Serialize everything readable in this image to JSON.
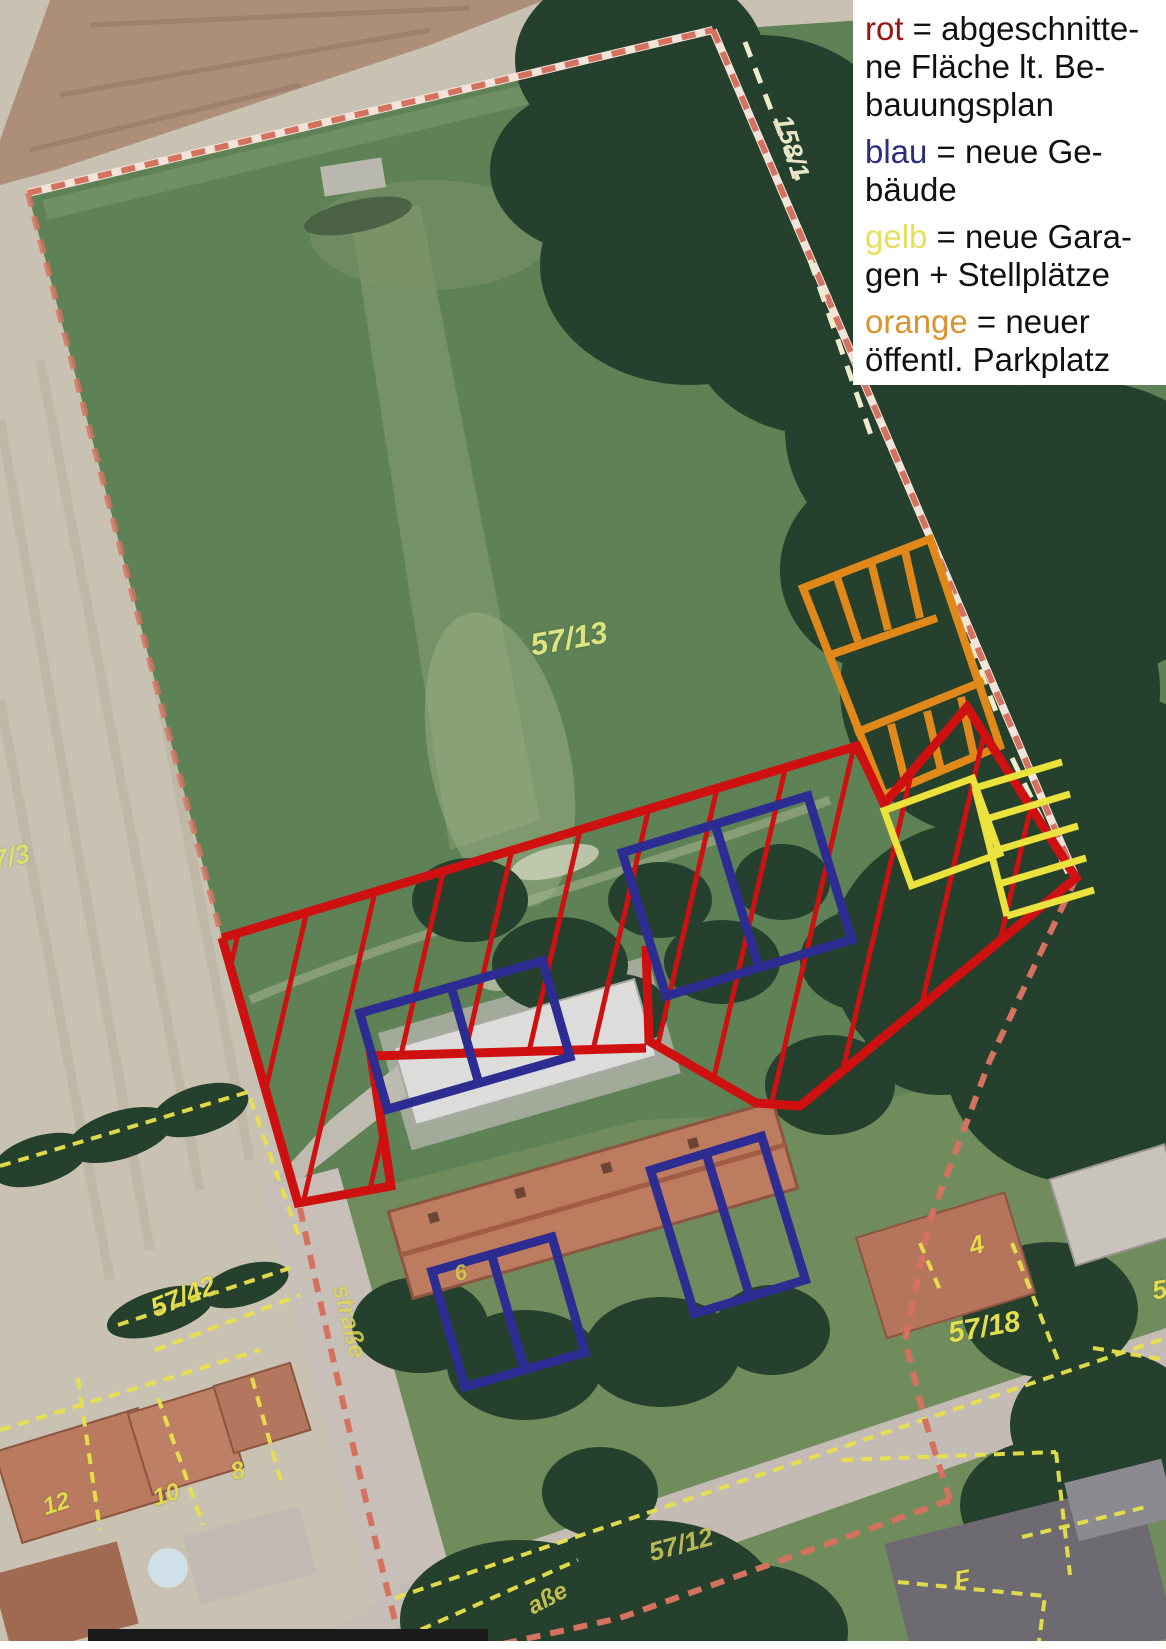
{
  "legend": {
    "background": "#ffffff",
    "entries": [
      {
        "term": "rot",
        "term_color": "#9c1414",
        "rest": " = abgeschnitte-",
        "line2": "ne Fläche lt. Be-",
        "line3": "bauungsplan"
      },
      {
        "term": "blau",
        "term_color": "#2d2d80",
        "rest": " = neue Ge-",
        "line2": "bäude"
      },
      {
        "term": "gelb",
        "term_color": "#e6e05c",
        "rest": " = neue Gara-",
        "line2": "gen + Stellplätze"
      },
      {
        "term": "orange",
        "term_color": "#d9942e",
        "rest": " = neuer",
        "line2": "öffentl. Parkplatz"
      }
    ]
  },
  "overlay_colors": {
    "red_cutoff_area": "#cf1010",
    "blue_new_buildings": "#2c2c92",
    "yellow_garages": "#ece23e",
    "orange_public_parking": "#e0891a",
    "pink_parcel_boundary": "#d4725f",
    "yellow_parcel_lines": "#e8e24a"
  },
  "map": {
    "labels": [
      {
        "text": "158/1"
      },
      {
        "text": "57/13"
      },
      {
        "text": "7/3"
      },
      {
        "text": "57/42"
      },
      {
        "text": "4"
      },
      {
        "text": "57/18"
      },
      {
        "text": "5"
      },
      {
        "text": "57/12"
      },
      {
        "text": "12"
      },
      {
        "text": "10"
      },
      {
        "text": "8"
      },
      {
        "text": "6"
      },
      {
        "text": "F"
      },
      {
        "text": "straße"
      },
      {
        "text": "aße"
      }
    ]
  }
}
